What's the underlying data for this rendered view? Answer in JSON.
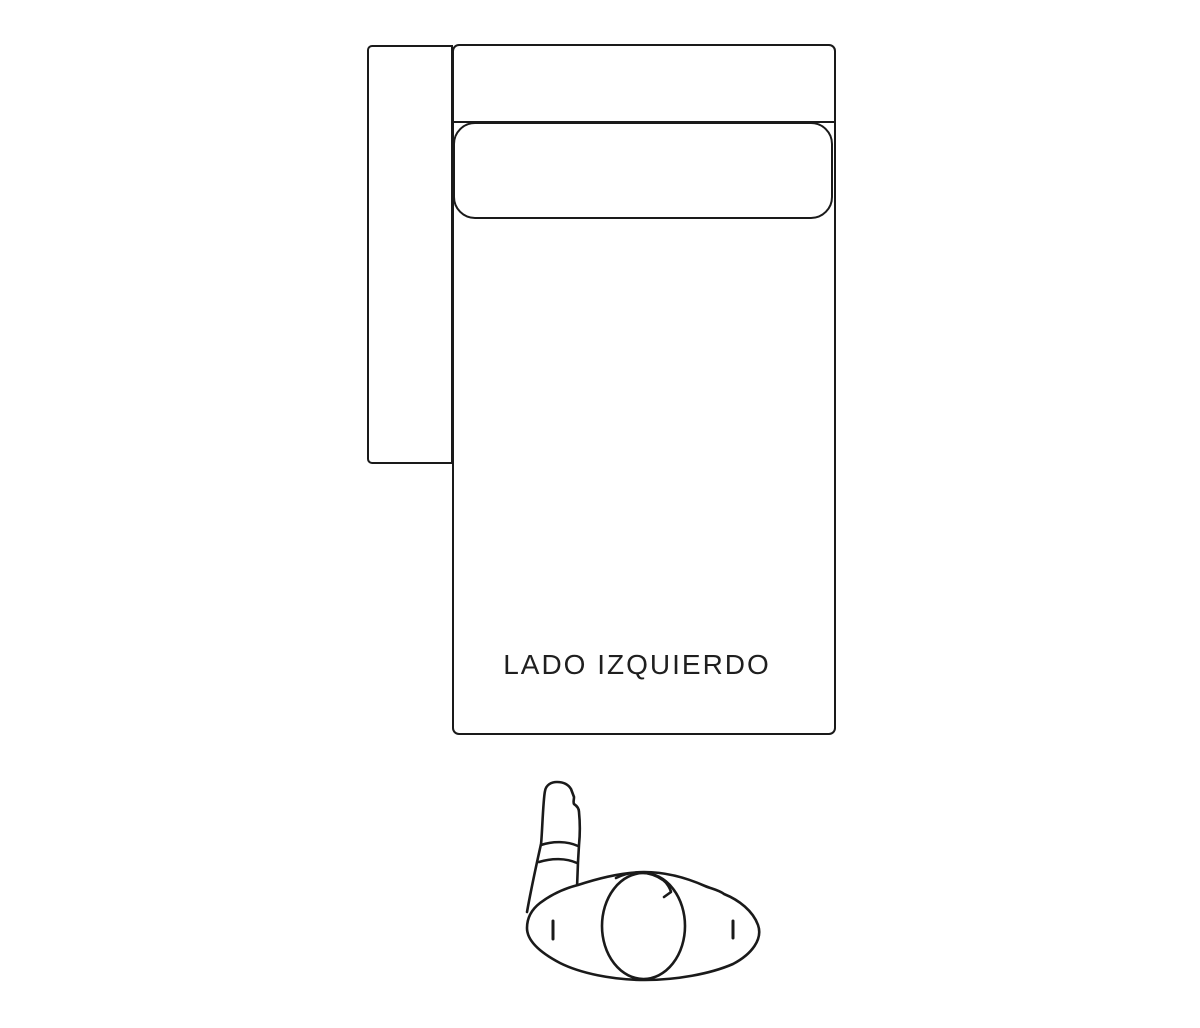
{
  "colors": {
    "background": "#ffffff",
    "line": "#1a1a1a",
    "text": "#1f1f1f"
  },
  "diagram": {
    "label": "LADO IZQUIERDO",
    "icons": {
      "figure": "person-top-view-icon"
    }
  }
}
